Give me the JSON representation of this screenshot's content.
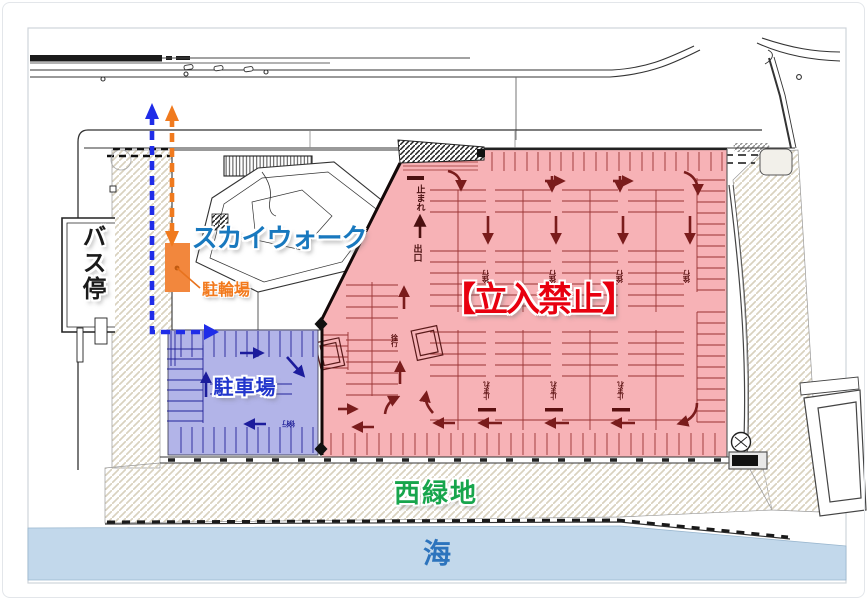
{
  "map": {
    "zones": {
      "no_entry": {
        "label": "【立入禁止】",
        "fill": "#f7b2b6",
        "text_color": "#e8000f"
      },
      "parking": {
        "label": "駐車場",
        "fill": "#b2b4e8",
        "text_color": "#2135cc"
      },
      "bicycle": {
        "label": "駐輪場",
        "fill": "#f2873d",
        "text_color": "#f2791c"
      },
      "skywalk": {
        "label": "スカイウォーク",
        "text_color": "#1878be"
      },
      "bus_stop": {
        "label": "バス停",
        "text_color": "#1a1a1a"
      },
      "west_green": {
        "label": "西緑地",
        "text_color": "#17a54c"
      },
      "sea": {
        "label": "海",
        "fill": "#c2d8eb",
        "text_color": "#2d74bd"
      }
    },
    "road_markings": {
      "stop": "止まれ",
      "exit": "出口",
      "slow": "徐行"
    },
    "routes": {
      "pedestrian_color": "#1f2ce8",
      "bicycle_color": "#f07a1e"
    },
    "lane_arrows": {
      "red": "#7a1c1c",
      "navy": "#1c1c9c"
    }
  }
}
